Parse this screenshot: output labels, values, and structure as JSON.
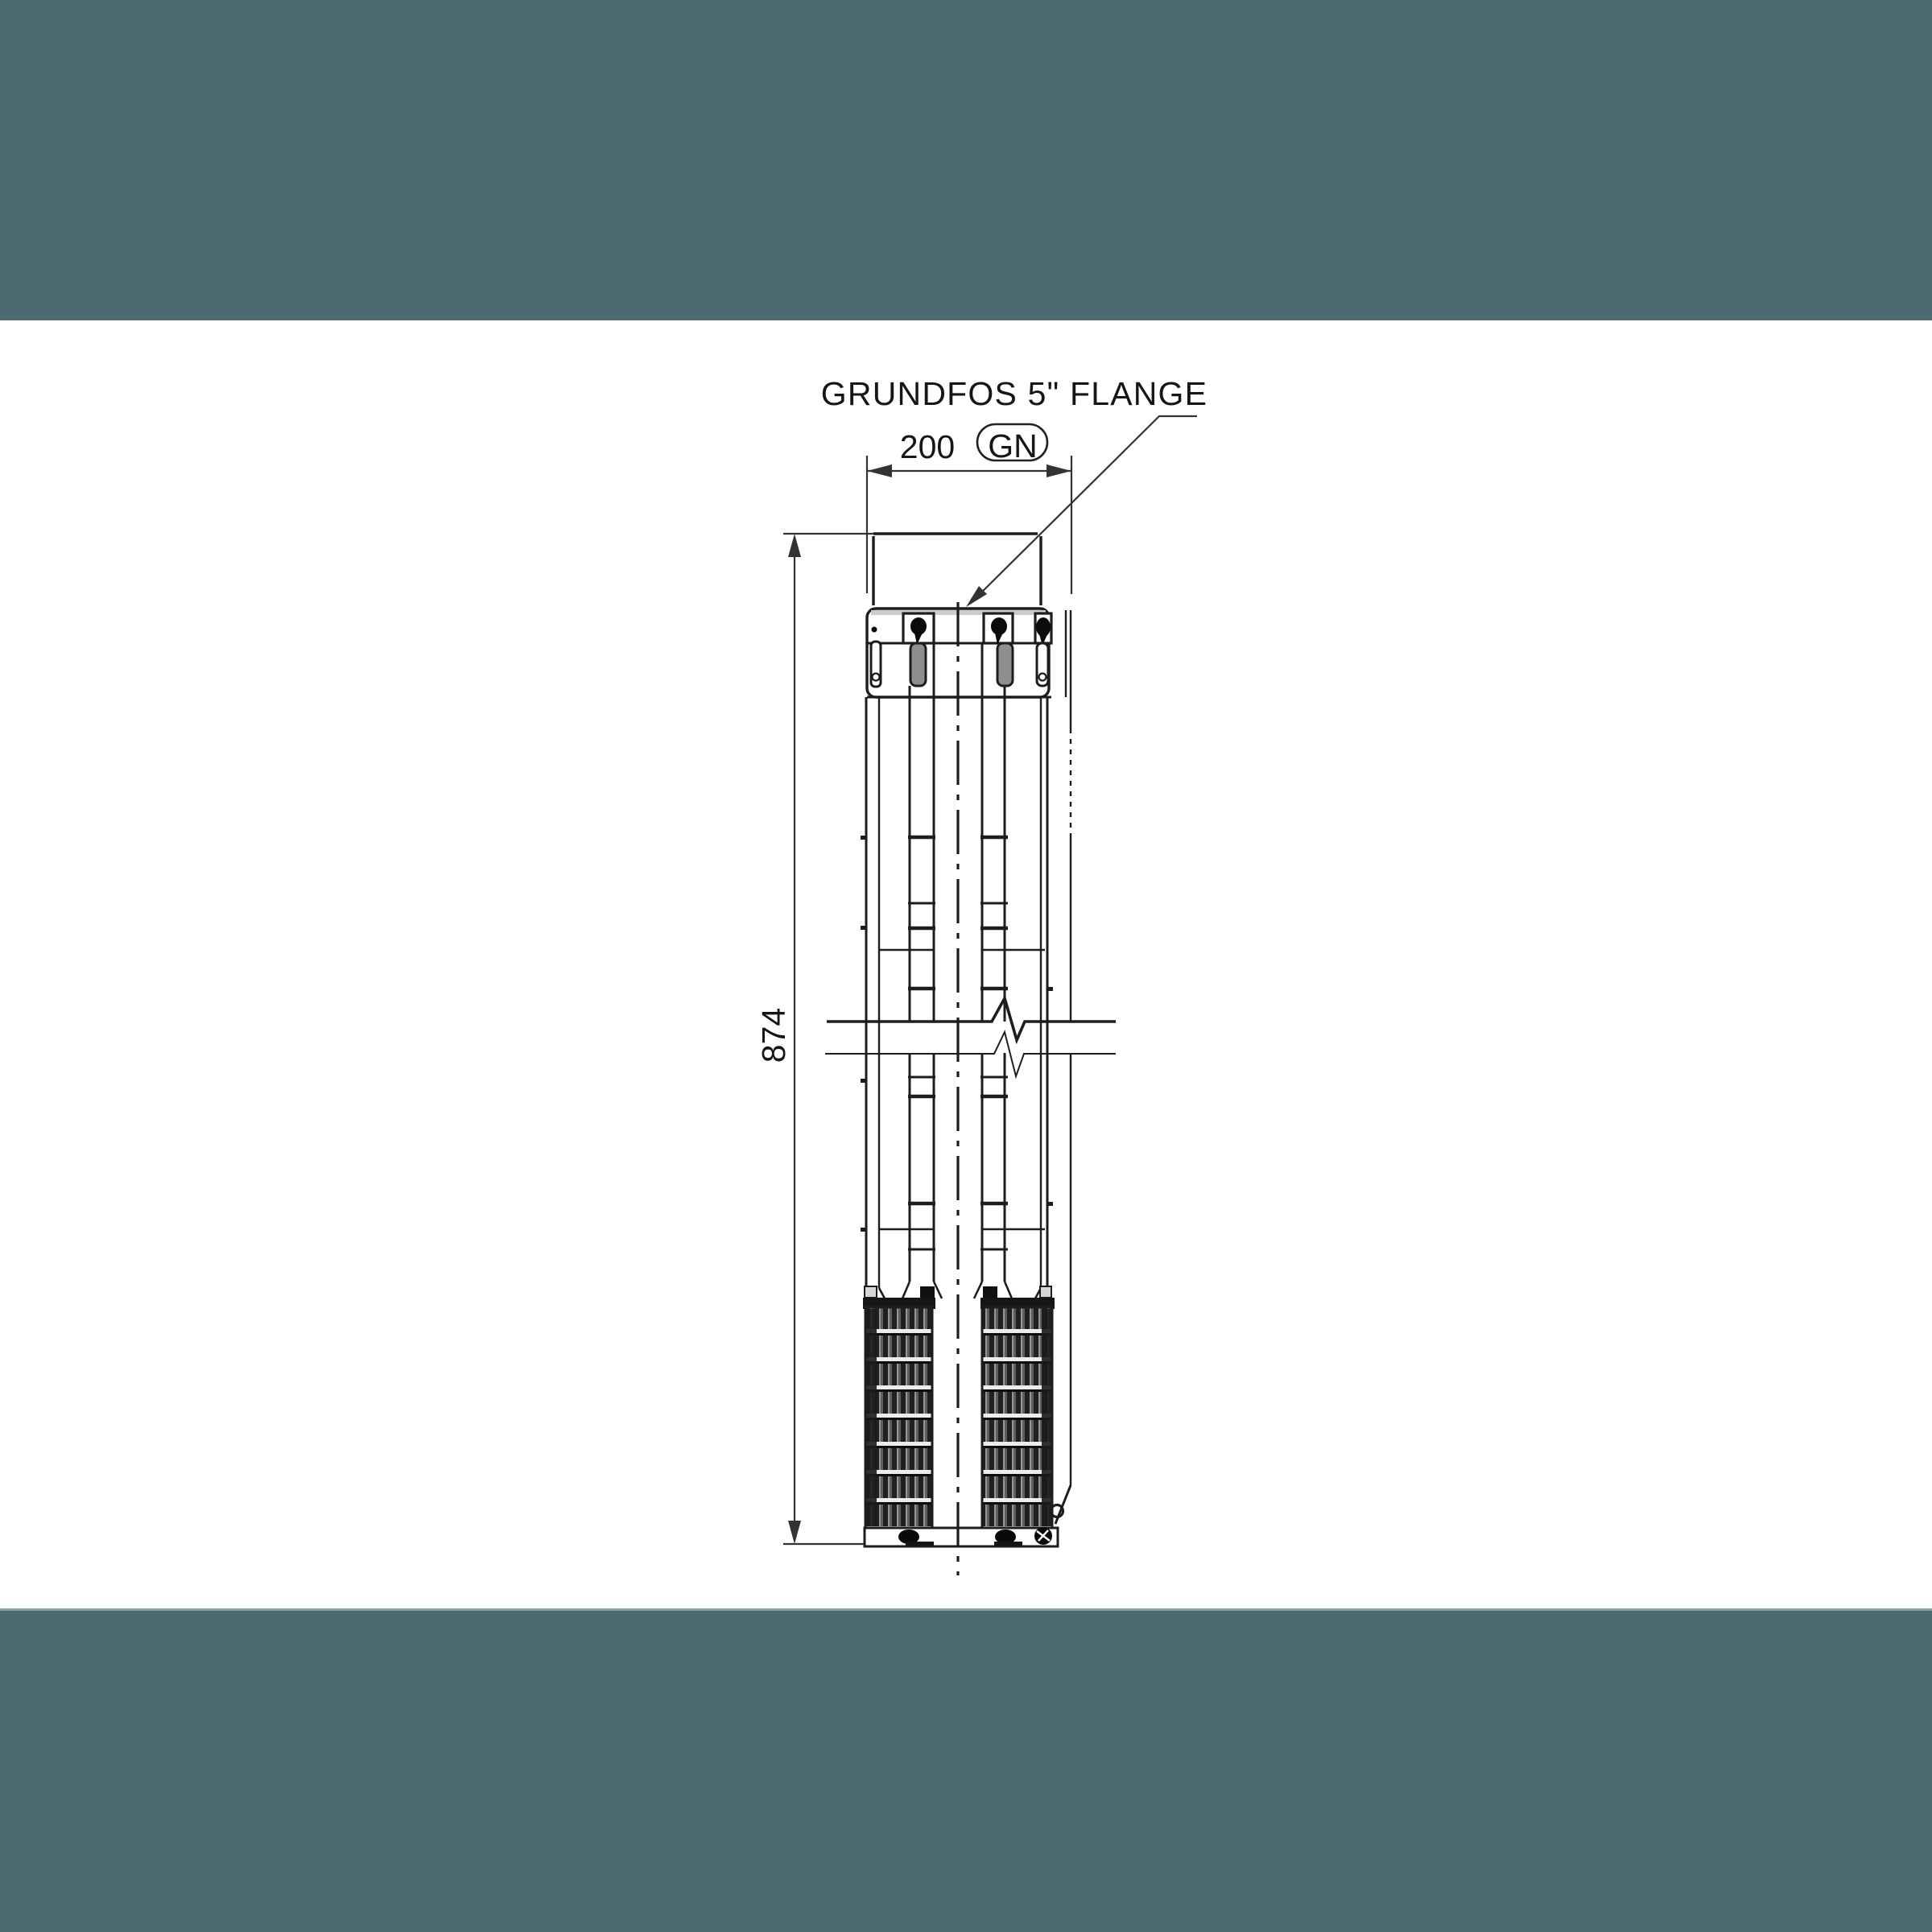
{
  "drawing": {
    "flange_label": "GRUNDFOS 5\" FLANGE",
    "width_dim_label": "200",
    "flange_code": "GN",
    "height_dim_label": "874"
  },
  "colors": {
    "band": "#4d6a72",
    "band_edge": "#8ba0a8",
    "paper": "#ffffff",
    "line": "#1d1d1d",
    "dim_line": "#333333",
    "text": "#161616",
    "slot_fill": "#8f8f8f"
  }
}
